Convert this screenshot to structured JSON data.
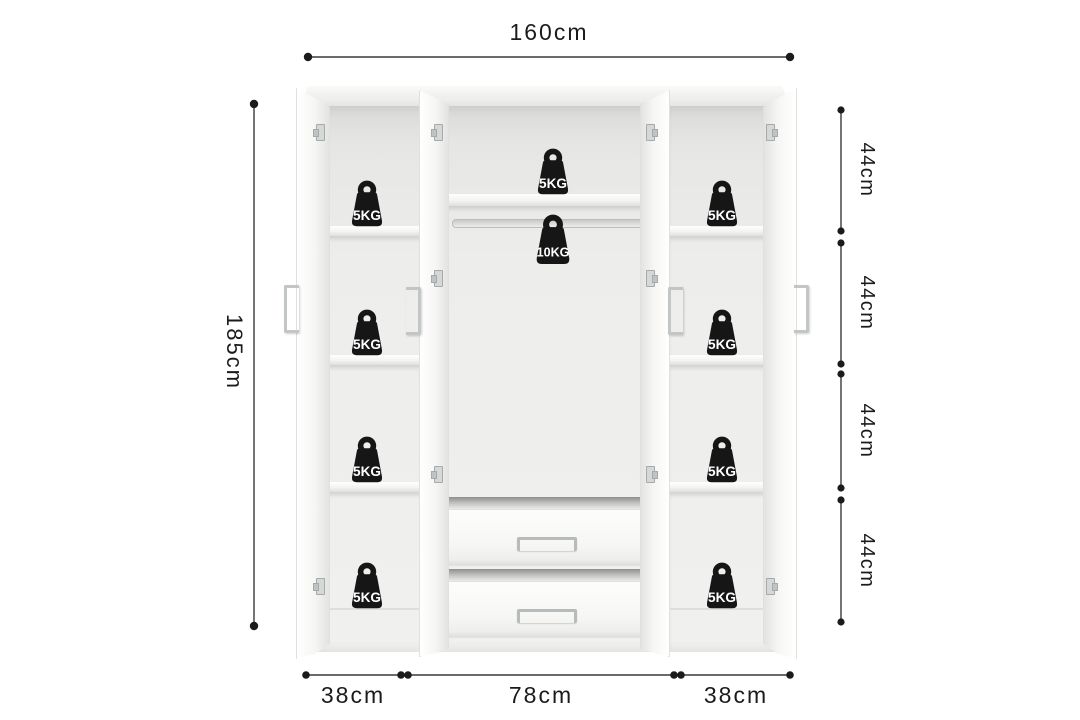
{
  "description": "Dimension diagram of a white 4-door wardrobe with open doors, side shelf columns, middle hanging rail and two drawers, annotated with shelf load ratings",
  "colors": {
    "background": "#ffffff",
    "cabinet": "#f2f2f0",
    "interior_wall": "#ebebe9",
    "icon": "#161616",
    "icon_text": "#ffffff",
    "dimension_line": "#3a3a3a",
    "handle": "#c2c6c6"
  },
  "dimensions": {
    "overall_width": {
      "label": "160cm",
      "cm": 160
    },
    "overall_height": {
      "label": "185cm",
      "cm": 185
    },
    "right_segments": [
      {
        "label": "44cm",
        "cm": 44
      },
      {
        "label": "44cm",
        "cm": 44
      },
      {
        "label": "44cm",
        "cm": 44
      },
      {
        "label": "44cm",
        "cm": 44
      }
    ],
    "bottom_segments": [
      {
        "label": "38cm",
        "cm": 38
      },
      {
        "label": "78cm",
        "cm": 78
      },
      {
        "label": "38cm",
        "cm": 38
      }
    ]
  },
  "load_ratings": {
    "left_shelves": [
      "5KG",
      "5KG",
      "5KG",
      "5KG"
    ],
    "middle": {
      "top_shelf": "5KG",
      "rail": "10KG"
    },
    "right_shelves": [
      "5KG",
      "5KG",
      "5KG",
      "5KG"
    ]
  }
}
